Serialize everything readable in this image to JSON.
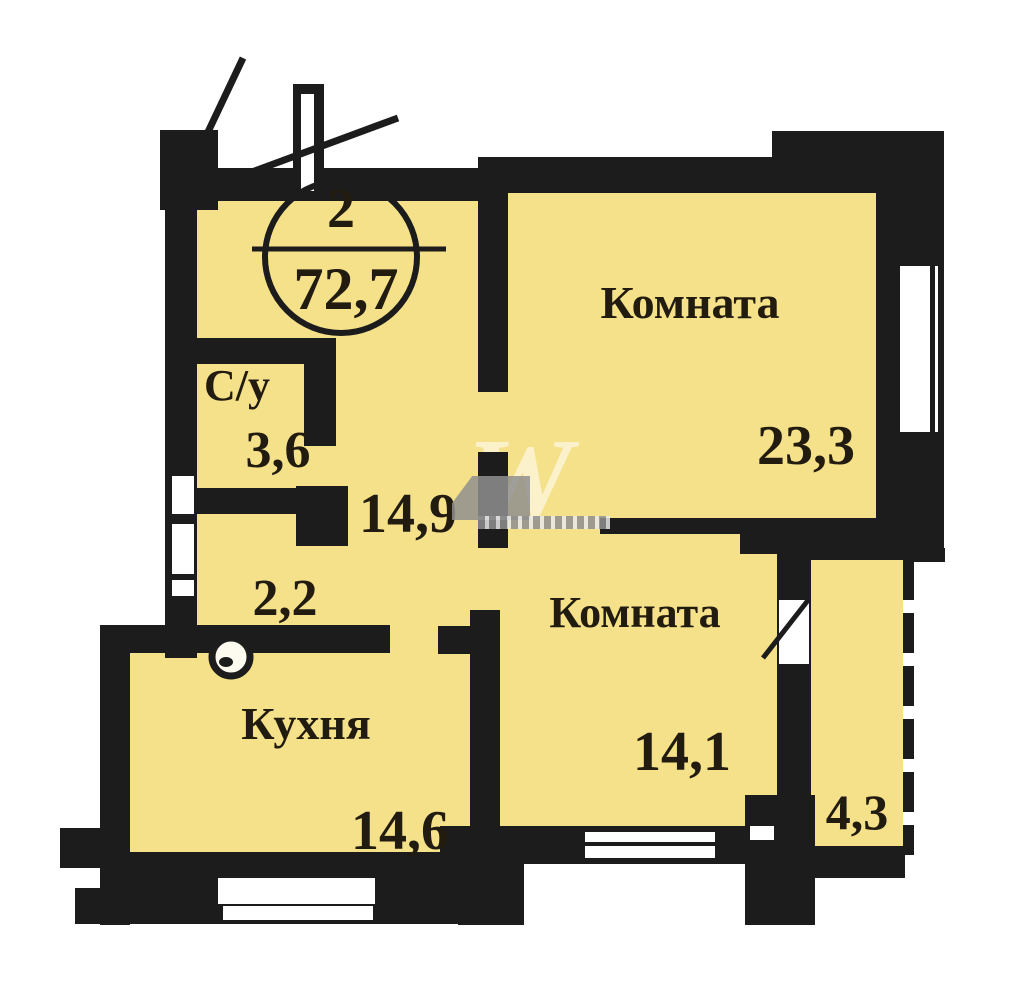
{
  "badge": {
    "rooms_count": "2",
    "total_area": "72,7"
  },
  "rooms": {
    "living_room": {
      "label": "Комната",
      "area": "23,3"
    },
    "bedroom": {
      "label": "Комната",
      "area": "14,1"
    },
    "kitchen": {
      "label": "Кухня",
      "area": "14,6"
    },
    "bathroom": {
      "label": "С/у",
      "area": "3,6"
    },
    "hallway": {
      "area": "14,9"
    },
    "corridor": {
      "area": "2,2"
    },
    "balcony": {
      "area": "4,3"
    }
  },
  "watermark": {
    "letters": "W"
  },
  "colors": {
    "room_fill": "#F5E189",
    "wall": "#1C1C1C",
    "text": "#211B10",
    "watermark_gray": "#8F8F8F"
  }
}
